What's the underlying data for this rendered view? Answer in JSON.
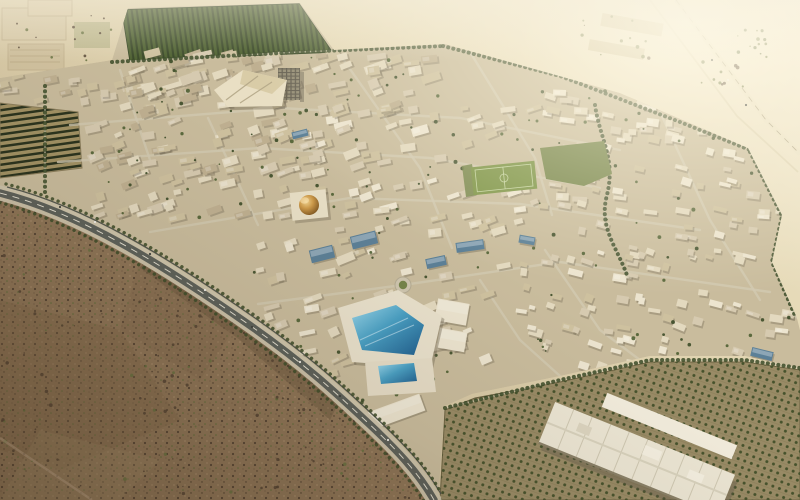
{
  "meta": {
    "title": "Aerial rendering of a desert eco-city masterplan",
    "description": "Bird's-eye architectural render: dense low-rise tan city blocks ringed by tree-lined roads in a sandy desert, with a golden dome, a pentagonal blue-glass innovation complex, dark orchard plantations, scrubland in the foreground and a highway crossing bright desert at top right."
  },
  "palette": {
    "scrubBase": "#8e male7557",
    "scrubBase2": "#8e7557",
    "scrubDark": "#544333",
    "scrubGreen": "#66713f",
    "cityBase": "#c9bc9d",
    "bld1": "#d6cab0",
    "bld2": "#cec19f",
    "bld3": "#bfb091",
    "bldLight": "#e3d9bf",
    "bldWhite": "#ece4cf",
    "bldShadow": "#6e6450",
    "treeGreen": "#4f5f33",
    "treeDark": "#3c4b28",
    "parkGreen": "#76854a",
    "pitchGreen": "#7d9447",
    "roadLight": "#d2c9b2",
    "orchardSoil": "#998b66",
    "glassBlue": "#5c8097",
    "poolBlue": "#2f6e9e",
    "domeGold": "#c99244"
  },
  "scene": {
    "boulevard_d": "M0,193 C80,213 165,266 248,324 C305,364 335,392 366,421 C396,449 418,472 434,500",
    "highway_d": "M676,0 L766,120 L800,154",
    "service_d": "M650,0 L737,116 L798,172",
    "track_d": "M0,438 L92,500",
    "orchard_road_d": "M445,408 L560,380 L650,360 L745,360 L800,368",
    "streets": [
      "M70,125 L280,108 L460,118 L620,150",
      "M58,162 L260,148 L430,158 L600,188",
      "M150,232 L350,198 L520,204 L700,230",
      "M258,304 L403,285 L560,262 L770,292",
      "M340,55 L420,168 L452,248",
      "M470,52 L535,158 L552,215",
      "M208,118 L258,225",
      "M120,70 L150,160",
      "M660,112 L710,220 L760,300",
      "M545,250 L600,330 L640,360",
      "M480,280 L520,340 L560,376"
    ],
    "greenways": [
      "M112,62 L300,52 L443,46",
      "M443,46 L560,76 L680,122 L800,170",
      "M750,152 L782,216 L772,262 L796,318",
      "M595,105 C600,140 616,158 607,195 C598,228 618,248 628,278",
      "M45,86 L45,192"
    ],
    "building_regions": [
      {
        "x": 118,
        "y": 52,
        "w": 320,
        "h": 62,
        "n": 95,
        "rot": -14,
        "s": [
          8,
          22,
          4,
          10
        ],
        "c": [
          "bld1",
          "bld2",
          "bldLight",
          "bld3"
        ]
      },
      {
        "x": 88,
        "y": 120,
        "w": 220,
        "h": 100,
        "n": 75,
        "rot": -16,
        "s": [
          7,
          18,
          4,
          9
        ],
        "c": [
          "bld1",
          "bld2",
          "bld3",
          "bldLight"
        ]
      },
      {
        "x": 300,
        "y": 108,
        "w": 240,
        "h": 125,
        "n": 75,
        "rot": -14,
        "s": [
          7,
          18,
          4,
          9
        ],
        "c": [
          "bld1",
          "bldLight",
          "bld2",
          "bldWhite"
        ]
      },
      {
        "x": 540,
        "y": 88,
        "w": 255,
        "h": 150,
        "n": 95,
        "rot": 10,
        "s": [
          6,
          15,
          3.5,
          8
        ],
        "c": [
          "bldLight",
          "bld1",
          "bldWhite",
          "bld2"
        ]
      },
      {
        "x": 520,
        "y": 245,
        "w": 275,
        "h": 125,
        "n": 75,
        "rot": 14,
        "s": [
          6,
          15,
          3.5,
          8
        ],
        "c": [
          "bldLight",
          "bldWhite",
          "bld1",
          "bld2"
        ]
      },
      {
        "x": 250,
        "y": 240,
        "w": 255,
        "h": 135,
        "n": 50,
        "rot": -18,
        "s": [
          7,
          19,
          4,
          9
        ],
        "c": [
          "bld1",
          "bldLight",
          "bld2",
          "bldWhite"
        ]
      },
      {
        "x": 0,
        "y": 76,
        "w": 110,
        "h": 26,
        "n": 14,
        "rot": -10,
        "s": [
          7,
          16,
          4,
          8
        ],
        "c": [
          "bld1",
          "bld2",
          "bld3"
        ]
      }
    ],
    "tree_regions": [
      {
        "x": 118,
        "y": 55,
        "w": 320,
        "h": 60,
        "n": 26
      },
      {
        "x": 88,
        "y": 120,
        "w": 220,
        "h": 100,
        "n": 26
      },
      {
        "x": 300,
        "y": 108,
        "w": 240,
        "h": 125,
        "n": 26
      },
      {
        "x": 540,
        "y": 88,
        "w": 255,
        "h": 150,
        "n": 30
      },
      {
        "x": 520,
        "y": 245,
        "w": 275,
        "h": 125,
        "n": 26
      },
      {
        "x": 250,
        "y": 240,
        "w": 255,
        "h": 135,
        "n": 20
      },
      {
        "x": 542,
        "y": 144,
        "w": 68,
        "h": 40,
        "n": 18
      },
      {
        "x": 335,
        "y": 290,
        "w": 120,
        "h": 120,
        "n": 14
      }
    ],
    "scatters": [
      {
        "g": "scrub-scatter",
        "x": 0,
        "y": 235,
        "w": 200,
        "h": 260,
        "n": 60,
        "c": [
          "scrubDark",
          "scrubGreen",
          "scrubDark"
        ]
      },
      {
        "g": "scrub-scatter",
        "x": 150,
        "y": 295,
        "w": 170,
        "h": 200,
        "n": 45,
        "c": [
          "scrubDark",
          "scrubGreen",
          "scrubDark"
        ]
      },
      {
        "g": "scrub-scatter",
        "x": 290,
        "y": 380,
        "w": 140,
        "h": 118,
        "n": 28,
        "c": [
          "scrubDark",
          "scrubGreen"
        ]
      },
      {
        "g": "desert-scatter",
        "x": 735,
        "y": 28,
        "w": 40,
        "h": 30,
        "n": 14,
        "c": [
          "scrubGreen",
          "treeGreen"
        ]
      },
      {
        "g": "desert-scatter",
        "x": 700,
        "y": 60,
        "w": 50,
        "h": 30,
        "n": 10,
        "c": [
          "scrubGreen",
          "scrubDark"
        ]
      },
      {
        "g": "desert-scatter",
        "x": 2,
        "y": 2,
        "w": 110,
        "h": 72,
        "n": 18,
        "c": [
          "scrubDark",
          "scrubGreen"
        ]
      },
      {
        "g": "desert-scatter",
        "x": 580,
        "y": 10,
        "w": 90,
        "h": 50,
        "n": 12,
        "c": [
          "scrubDark",
          "scrubGreen"
        ]
      }
    ],
    "feature_buildings": [
      {
        "x": 364,
        "y": 240,
        "w": 26,
        "h": 13,
        "rot": -14,
        "c": "glassBlue"
      },
      {
        "x": 322,
        "y": 254,
        "w": 24,
        "h": 13,
        "rot": -14,
        "c": "glassBlue"
      },
      {
        "x": 470,
        "y": 246,
        "w": 28,
        "h": 10,
        "rot": -8,
        "c": "glassBlue"
      },
      {
        "x": 436,
        "y": 262,
        "w": 20,
        "h": 10,
        "rot": -12,
        "c": "glassBlue"
      },
      {
        "x": 527,
        "y": 240,
        "w": 16,
        "h": 8,
        "rot": 10,
        "c": "glassBlue"
      },
      {
        "x": 300,
        "y": 134,
        "w": 16,
        "h": 7,
        "rot": -14,
        "c": "glassBlue"
      },
      {
        "x": 762,
        "y": 354,
        "w": 22,
        "h": 9,
        "rot": 14,
        "c": "glassBlue"
      },
      {
        "x": 452,
        "y": 312,
        "w": 32,
        "h": 22,
        "rot": 10,
        "c": "bldWhite"
      },
      {
        "x": 452,
        "y": 340,
        "w": 28,
        "h": 20,
        "rot": 10,
        "c": "bldWhite"
      },
      {
        "x": 395,
        "y": 412,
        "w": 58,
        "h": 18,
        "rot": -20,
        "c": "bldWhite"
      }
    ],
    "cars": [
      [
        60,
        207,
        "d"
      ],
      [
        95,
        222,
        "w"
      ],
      [
        150,
        254,
        "d"
      ],
      [
        205,
        290,
        "w"
      ],
      [
        252,
        327,
        "d"
      ],
      [
        300,
        362,
        "w"
      ],
      [
        340,
        396,
        "d"
      ],
      [
        388,
        440,
        "w"
      ],
      [
        712,
        60,
        "d"
      ],
      [
        728,
        80,
        "w"
      ],
      [
        746,
        105,
        "d"
      ]
    ]
  }
}
